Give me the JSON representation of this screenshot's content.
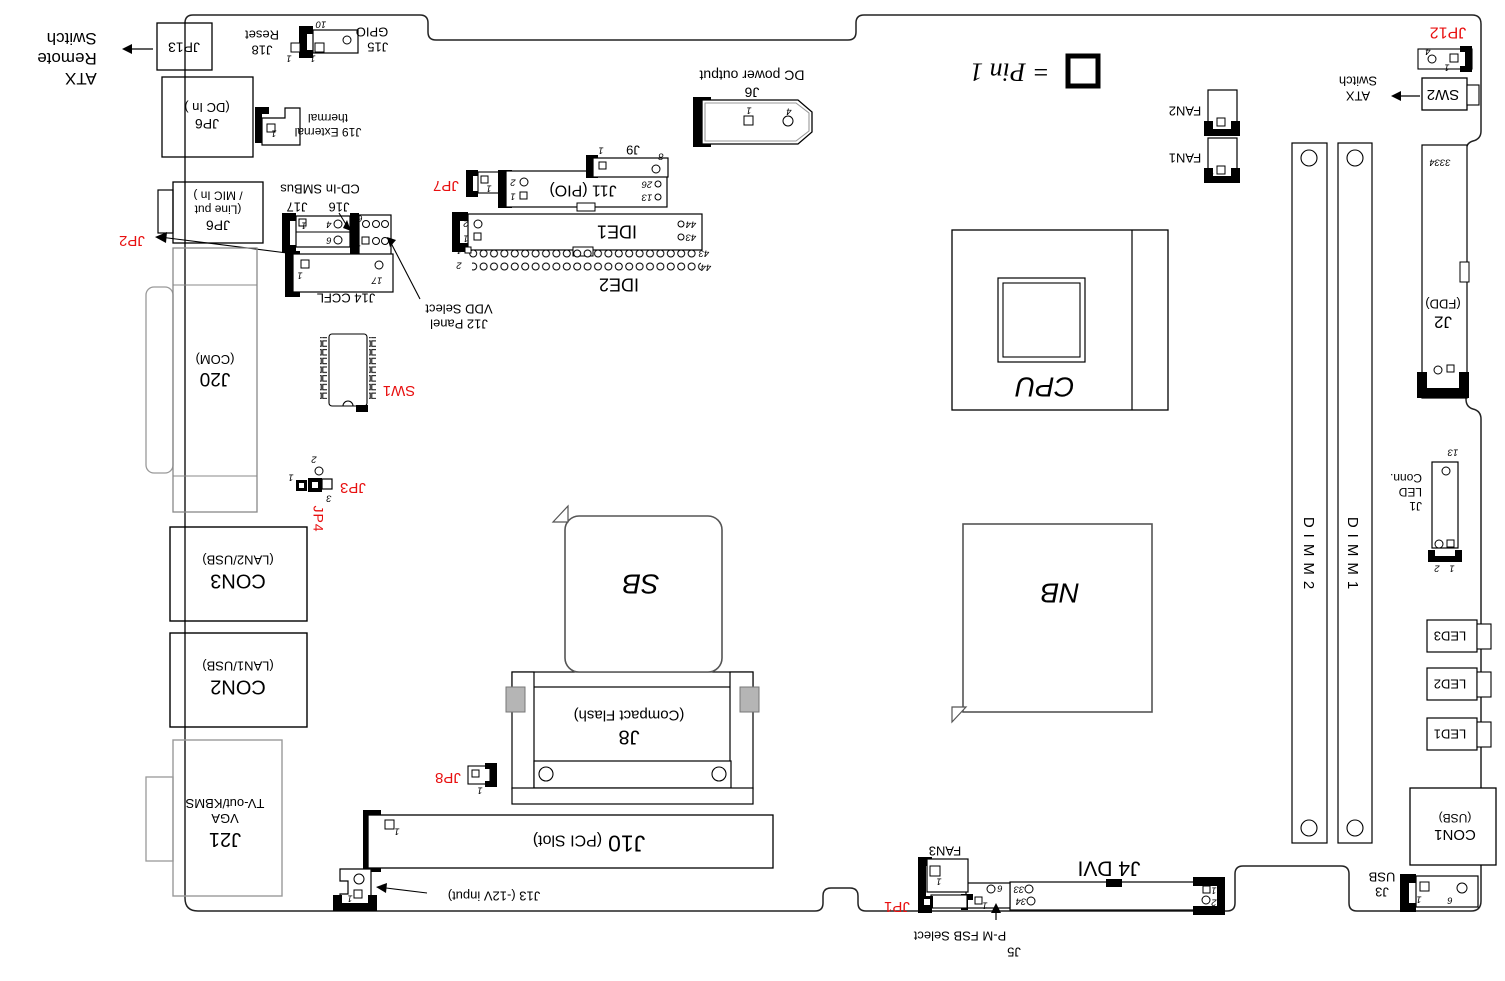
{
  "diagram": {
    "colors": {
      "red_label": "#e81010",
      "line": "#000000"
    },
    "legend": {
      "symbol_note": "= Pin 1"
    },
    "chips": {
      "cpu": "CPU",
      "nb": "NB",
      "sb": "SB"
    },
    "memory": {
      "dimm1": "DIMM1",
      "dimm2": "DIMM2"
    },
    "callouts": {
      "atx_remote": {
        "l1": "ATX",
        "l2": "Remote",
        "l3": "Switch"
      },
      "atx_switch": {
        "l1": "ATX",
        "l2": "Switch"
      },
      "p_m_fsb": "P-M FSB Select",
      "j12_panel": {
        "l1": "J12 Panel",
        "l2": "VDD Select"
      },
      "j13_label": "J13 (-12V input)",
      "cd_in": "CD-In SMBus"
    },
    "connectors": {
      "jp13": {
        "name": "JP13"
      },
      "jp6_dc": {
        "name": "JP6",
        "desc": "(DC In )"
      },
      "jp6_audio": {
        "name": "JP6",
        "l2": "(Line put",
        "l3": "/ MIC In )"
      },
      "j18": {
        "name": "J18",
        "desc": "Reset",
        "pin1": "1"
      },
      "j15": {
        "name": "J15",
        "desc": "GPIO",
        "pin10": "10"
      },
      "j19": {
        "name": "J19 External",
        "desc": "thermal",
        "pin1": "1"
      },
      "jp2": {
        "name": "JP2"
      },
      "j17": {
        "name": "J17",
        "pin1": "1",
        "pin4": "4",
        "pin6": "6"
      },
      "j16": {
        "name": "J16",
        "pin1": "1",
        "pin6": "6"
      },
      "j14": {
        "name": "J14 CCFL",
        "pin1": "1",
        "pin17": "17"
      },
      "jp7": {
        "name": "JP7",
        "pin1": "1"
      },
      "j11": {
        "name": "J11 (PIO)",
        "pin1": "1",
        "pin2": "2",
        "pin13": "13",
        "pin26": "26"
      },
      "j9": {
        "name": "J9",
        "pin1": "1",
        "pin8": "8"
      },
      "j6": {
        "name": "J6",
        "desc": "DC power output",
        "pin1": "1",
        "pin4": "4"
      },
      "ide1": {
        "name": "IDE1",
        "pin1": "1",
        "pin2": "2",
        "pin43": "43",
        "pin44": "44"
      },
      "ide2": {
        "name": "IDE2",
        "pin1": "1",
        "pin2": "2",
        "pin43": "43",
        "pin44": "44"
      },
      "jp12": {
        "name": "JP12",
        "pin1": "1",
        "pin4": "4"
      },
      "sw2": {
        "name": "SW2"
      },
      "fan1": {
        "name": "FAN1",
        "pin1": "1"
      },
      "fan2": {
        "name": "FAN2"
      },
      "fan3": {
        "name": "FAN3",
        "pin1": "1"
      },
      "j2": {
        "name": "J2",
        "desc": "(FDD)",
        "pin33": "33",
        "pin34": "34"
      },
      "j1": {
        "l1": "J1",
        "l2": "LED",
        "l3": "Conn.",
        "pin13": "13",
        "pin1": "1",
        "pin2": "2"
      },
      "led1": {
        "name": "LED1"
      },
      "led2": {
        "name": "LED2"
      },
      "led3": {
        "name": "LED3"
      },
      "con1": {
        "name": "CON1",
        "desc": "(USB)"
      },
      "j3": {
        "name": "J3",
        "desc": "USB",
        "pin1": "1",
        "pin6": "6"
      },
      "j4": {
        "name": "J4 DVI",
        "pin1": "1",
        "pin2": "2",
        "pin33": "33",
        "pin34": "34"
      },
      "j5": {
        "name": "J5",
        "pin1": "1",
        "pin6": "6"
      },
      "jp1": {
        "name": "JP1"
      },
      "j10": {
        "name": "J10",
        "desc": "(PCI Slot)",
        "pin1": "1"
      },
      "j13": {
        "pin1": "1"
      },
      "jp8": {
        "name": "JP8",
        "pin1": "1"
      },
      "j8": {
        "name": "J8",
        "desc": "(Compact Flash)"
      },
      "j20": {
        "name": "J20",
        "desc": "(COM)"
      },
      "sw1": {
        "name": "SW1"
      },
      "jp3": {
        "name": "JP3",
        "pin1": "1",
        "pin2": "2",
        "pin3": "3"
      },
      "jp4": {
        "name": "JP4"
      },
      "con3": {
        "name": "CON3",
        "desc": "(LAN2/USB)"
      },
      "con2": {
        "name": "CON2",
        "desc": "(LAN1/USB)"
      },
      "j21": {
        "l1": "J21",
        "l2": "VGA",
        "l3": "TV-out/KBMS"
      }
    }
  }
}
